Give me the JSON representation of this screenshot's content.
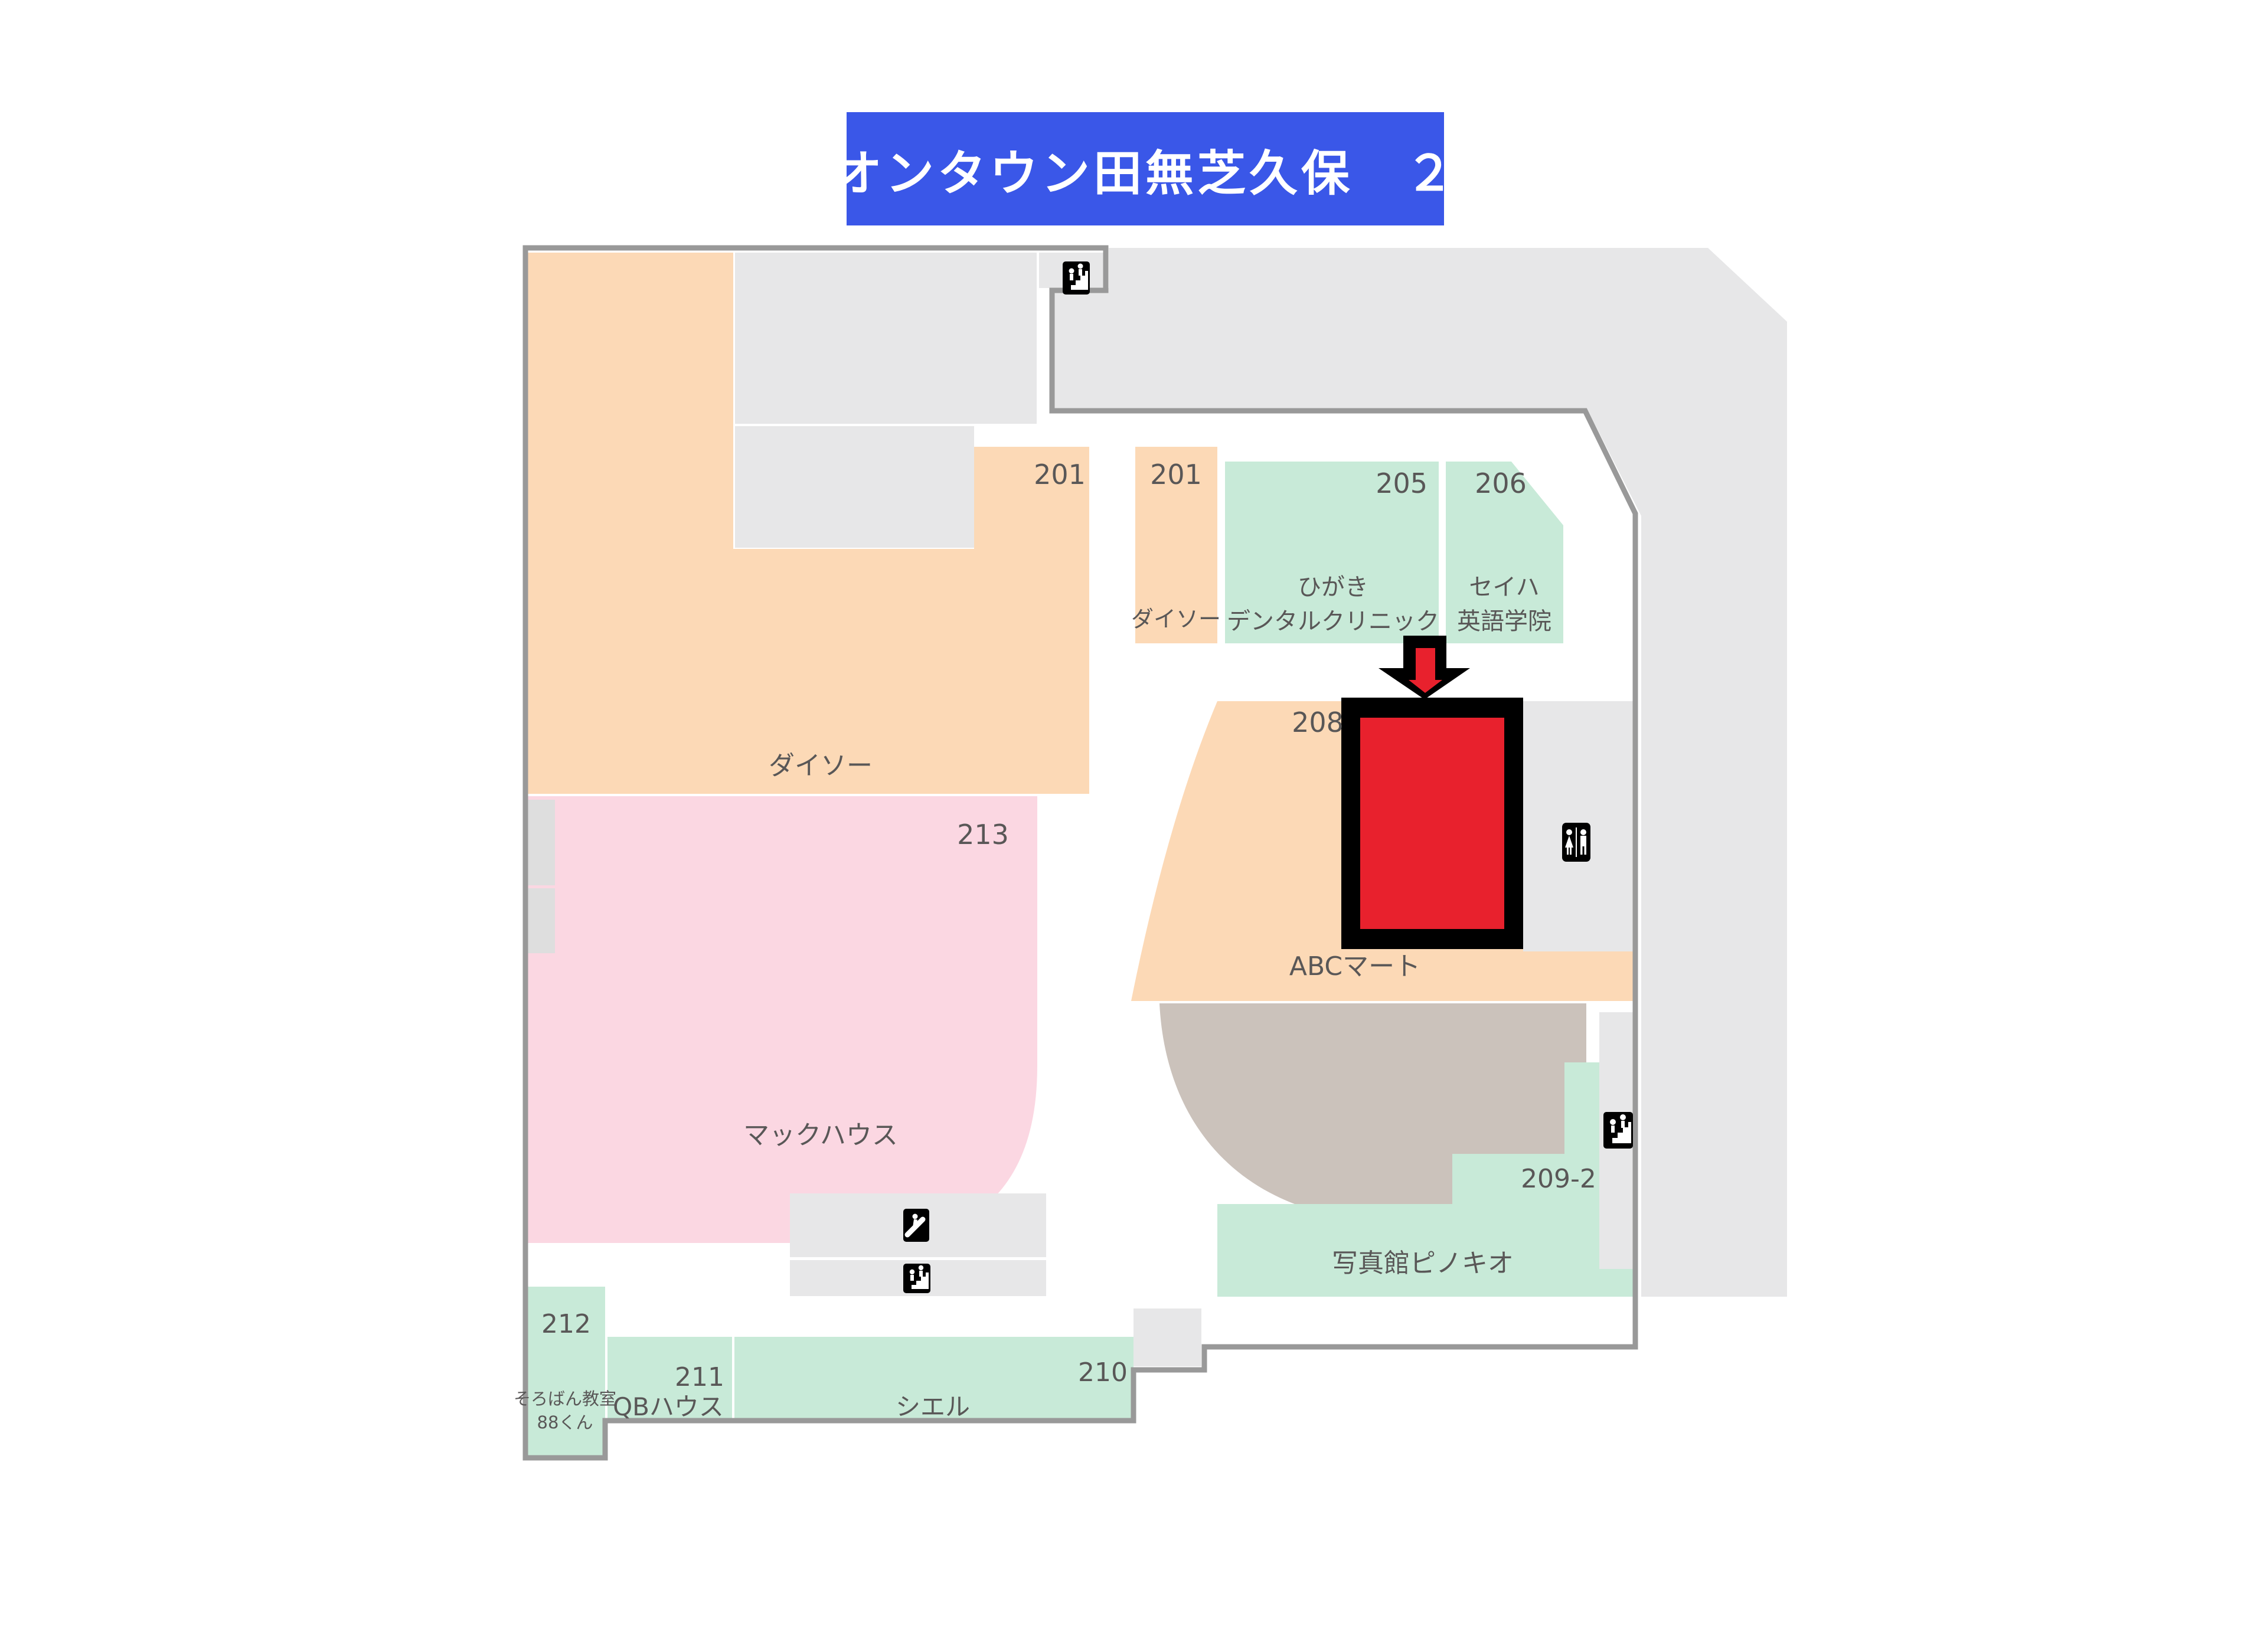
{
  "title": {
    "text": "イオンタウン田無芝久保　２Ｆ"
  },
  "colors": {
    "banner_blue": "#3a57e8",
    "outline_gray": "#999999",
    "corridor_gray": "#e7e7e8",
    "store_orange": "#fcd9b6",
    "store_pink": "#fbd7e2",
    "store_green": "#c8ead8",
    "store_taupe": "#cbc2bb",
    "highlight_red": "#e8212d",
    "label_text": "#595757"
  },
  "stores": {
    "unit201_hall": {
      "number": "201"
    },
    "unit201_daiso": {
      "number": "201",
      "name": "ダイソー"
    },
    "unit205": {
      "number": "205",
      "name_line1": "ひがき",
      "name_line2": "デンタルクリニック"
    },
    "unit206": {
      "number": "206",
      "name_line1": "セイハ",
      "name_line2": "英語学院"
    },
    "unit208": {
      "number": "208"
    },
    "daiso_main": {
      "name": "ダイソー"
    },
    "unit213": {
      "number": "213",
      "name": "マックハウス"
    },
    "abc_mart": {
      "name": "ABCマート"
    },
    "unit209_2": {
      "number": "209-2",
      "name": "写真館ピノキオ"
    },
    "unit212": {
      "number": "212",
      "name_line1": "そろばん教室",
      "name_line2": "88くん"
    },
    "unit211": {
      "number": "211",
      "name": "QBハウス"
    },
    "unit210": {
      "number": "210",
      "name": "シエル"
    }
  },
  "icons": {
    "stairs_top": "stairs",
    "escalator_center": "escalator",
    "stairs_center": "stairs",
    "stairs_right": "stairs",
    "restroom": "restroom"
  },
  "marker": {
    "highlighted_unit_number": "208"
  }
}
